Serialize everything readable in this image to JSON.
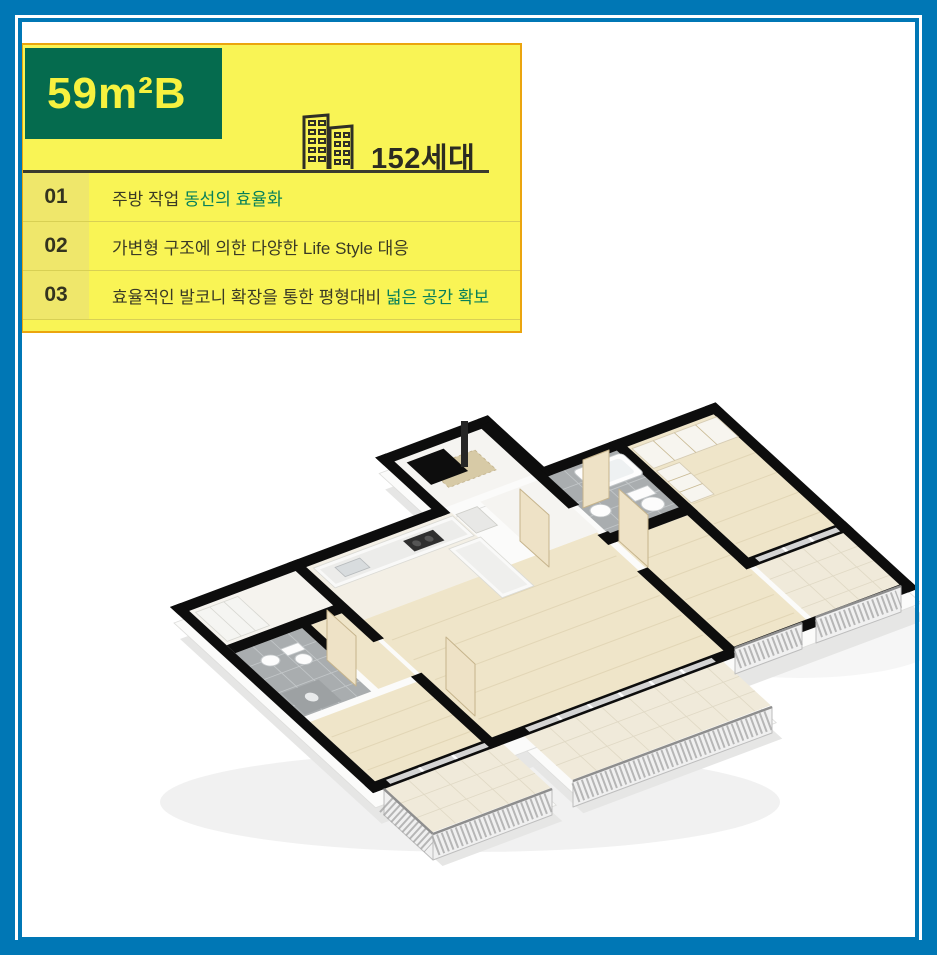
{
  "colors": {
    "frame_blue": "#0077B5",
    "panel_yellow": "#F9F455",
    "panel_border_orange": "#EBA50E",
    "badge_green": "#056B4E",
    "badge_text_yellow": "#F7F13F",
    "accent_green": "#07805A",
    "text_dark": "#3A3A25"
  },
  "panel": {
    "unit_label": "59m²B",
    "households": "152세대",
    "building_icon": "buildings-icon"
  },
  "features": [
    {
      "no": "01",
      "plain": "주방 작업 ",
      "accent": "동선의 효율화"
    },
    {
      "no": "02",
      "plain": "가변형 구조에 의한 다양한 Life Style 대응",
      "accent": ""
    },
    {
      "no": "03",
      "plain": "효율적인 발코니 확장을 통한 평형대비 ",
      "accent": "넓은 공간 확보"
    }
  ],
  "floorplan": {
    "alt": "3D isometric floor plan render of the 59m² type B unit: living room, kitchen, bedrooms, two bathrooms, entry and balconies with railings"
  }
}
